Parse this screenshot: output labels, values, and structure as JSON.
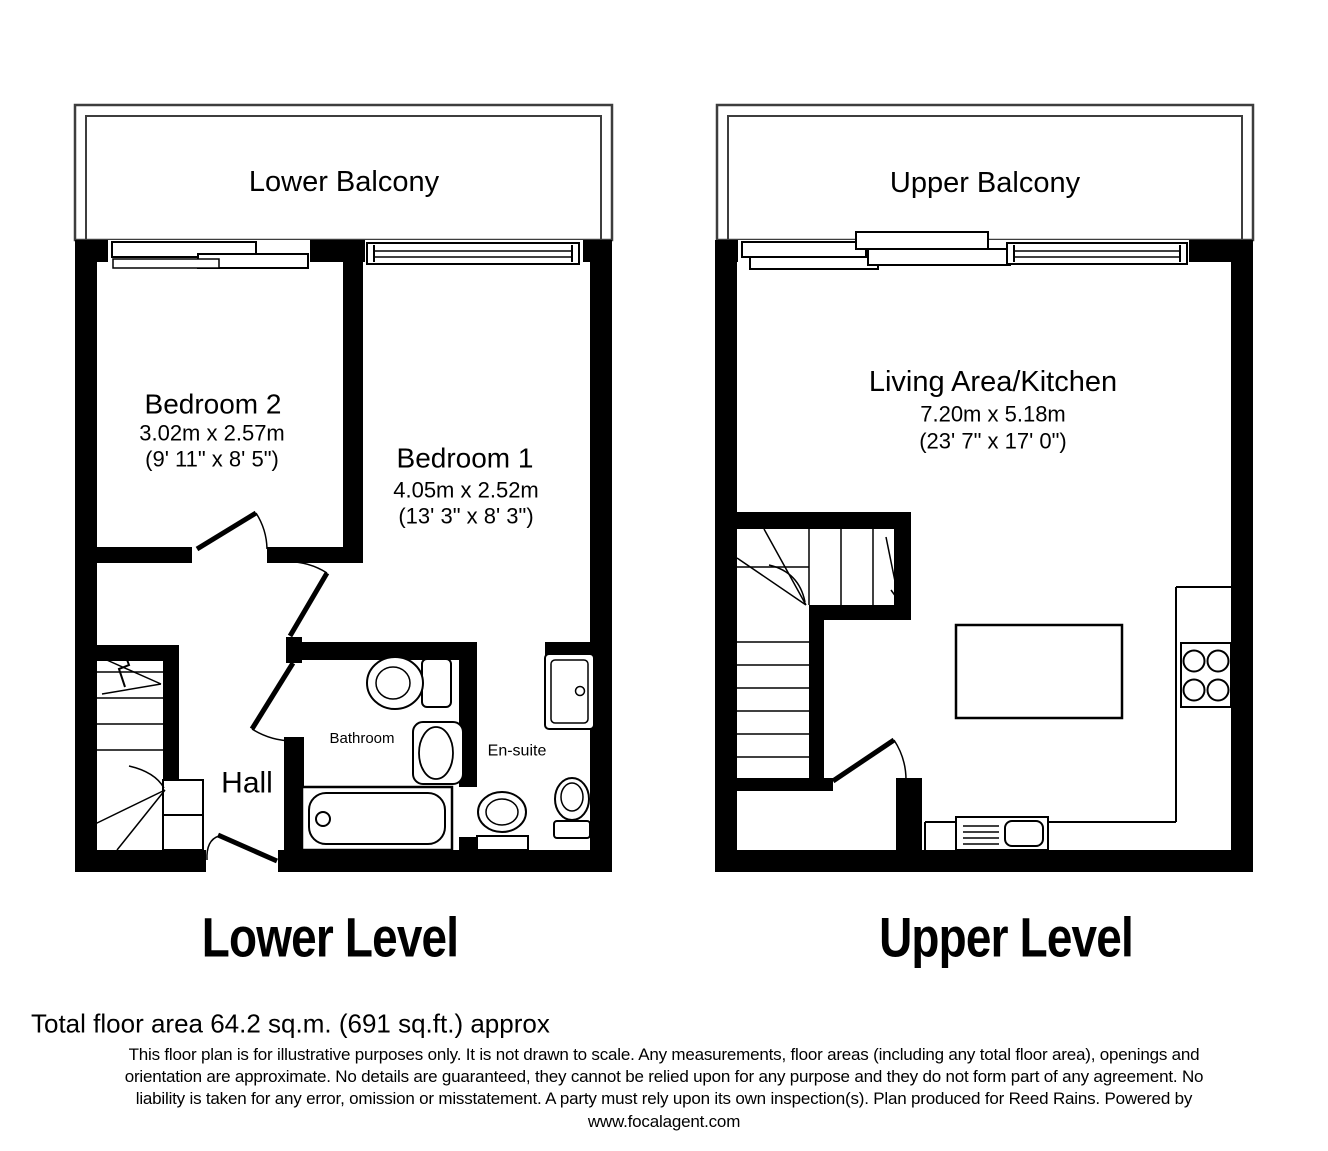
{
  "colors": {
    "wall": "#000000",
    "balcony_outline": "#3d3d3d",
    "background": "#ffffff",
    "text": "#000000"
  },
  "lower": {
    "balcony_label": "Lower Balcony",
    "title": "Lower Level",
    "bedroom2": {
      "name": "Bedroom 2",
      "metric": "3.02m x 2.57m",
      "imperial": "(9' 11\" x 8' 5\")"
    },
    "bedroom1": {
      "name": "Bedroom 1",
      "metric": "4.05m x 2.52m",
      "imperial": "(13' 3\" x 8' 3\")"
    },
    "hall_label": "Hall",
    "bathroom_label": "Bathroom",
    "ensuite_label": "En-suite"
  },
  "upper": {
    "balcony_label": "Upper Balcony",
    "title": "Upper Level",
    "living": {
      "name": "Living Area/Kitchen",
      "metric": "7.20m x 5.18m",
      "imperial": "(23' 7\" x 17' 0\")"
    }
  },
  "footer": {
    "total_area": "Total floor area 64.2 sq.m. (691 sq.ft.) approx",
    "disclaimer_line1": "This floor plan is for illustrative purposes only. It is not drawn to scale. Any measurements, floor areas (including any total floor area), openings and",
    "disclaimer_line2": "orientation are approximate. No details are guaranteed, they cannot be relied upon for any purpose and they do not form part of any agreement. No",
    "disclaimer_line3": "liability is taken for any error, omission or misstatement. A party must rely upon its own inspection(s). Plan produced for Reed Rains. Powered by",
    "website": "www.focalagent.com"
  }
}
